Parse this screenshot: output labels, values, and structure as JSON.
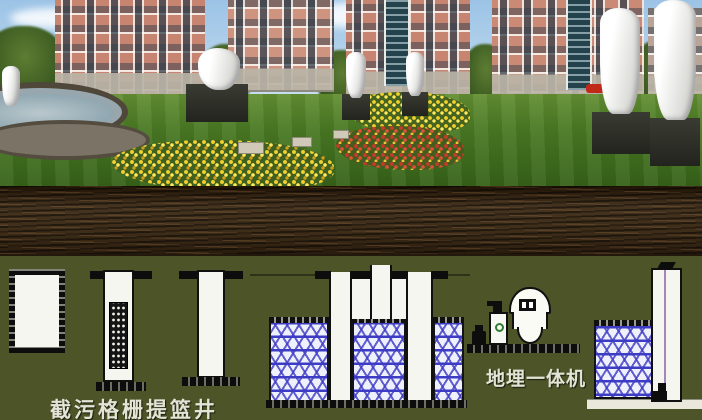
{
  "labels": {
    "grille_well": "截污格栅提篮井",
    "buried_unit": "地埋一体机"
  },
  "colors": {
    "underground_olive": "#4c5428",
    "soil_brown": "#3a2817",
    "media_lattice_blue": "#3c3cc4",
    "outline_black": "#0d0d0d",
    "structure_white": "#f6f6f0",
    "label_text": "#e4e4d6",
    "pipe_purple": "#a487b8",
    "dosing_logo_green": "#2e7d32",
    "building_brick": "#c68471",
    "lawn_green": "#4a7a24",
    "flower_yellow": "#f2d02e",
    "flower_red": "#c23a28"
  }
}
